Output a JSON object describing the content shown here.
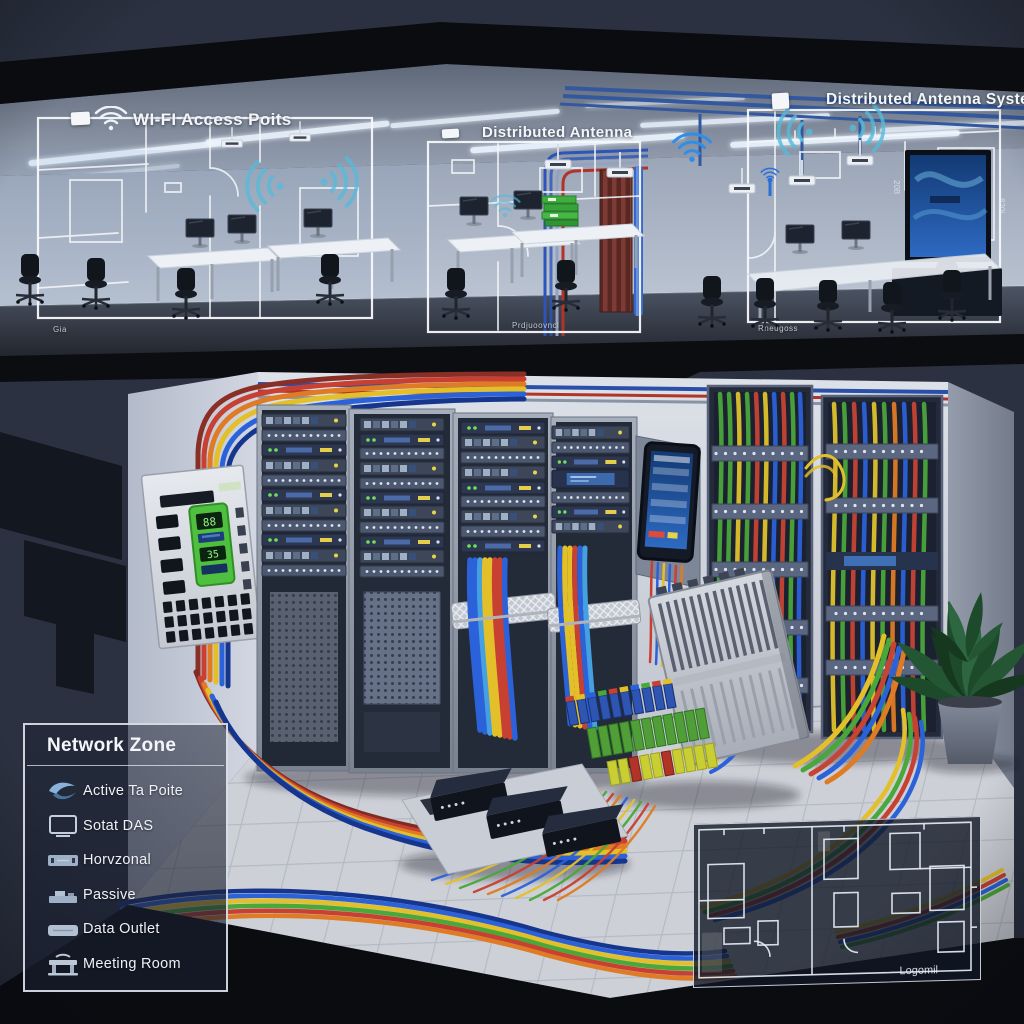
{
  "palette": {
    "background": "#2b3140",
    "slab": "#0b0d11",
    "wall_upper": "#a9b3c3",
    "wall_lower": "#d2d6df",
    "cable_blue": "#2b62d9",
    "cable_red": "#c84031",
    "cable_yellow": "#e3c029",
    "cable_green": "#4aa838",
    "cable_orange": "#de7b24",
    "wifi_teal": "#54bbdc",
    "screen_blue": "#2e6ac2",
    "panel_green": "#4fbf3f"
  },
  "upper_floor": {
    "zones": [
      {
        "title": "WI-FI Access Poits",
        "footer": "Gia"
      },
      {
        "title": "Distributed Antenna",
        "footer": "Prdjuoovncl"
      },
      {
        "title": "Distributed Antenna System",
        "footer": "Rneugoss",
        "side_label_left": "20B",
        "side_label_right": "820i"
      }
    ]
  },
  "server_room": {
    "panel_display": {
      "value_top": "88",
      "value_bottom": "35"
    }
  },
  "legend": {
    "title": "Network Zone",
    "items": [
      {
        "icon": "active-tap-icon",
        "label": "Active Ta Poite"
      },
      {
        "icon": "das-display-icon",
        "label": "Sotat DAS"
      },
      {
        "icon": "horizontal-panel-icon",
        "label": "Horvzonal"
      },
      {
        "icon": "passive-device-icon",
        "label": "Passive"
      },
      {
        "icon": "data-outlet-icon",
        "label": "Data Outlet"
      },
      {
        "icon": "meeting-room-icon",
        "label": "Meeting Room"
      }
    ]
  },
  "floorplan_inset": {
    "label": "Logomil"
  }
}
